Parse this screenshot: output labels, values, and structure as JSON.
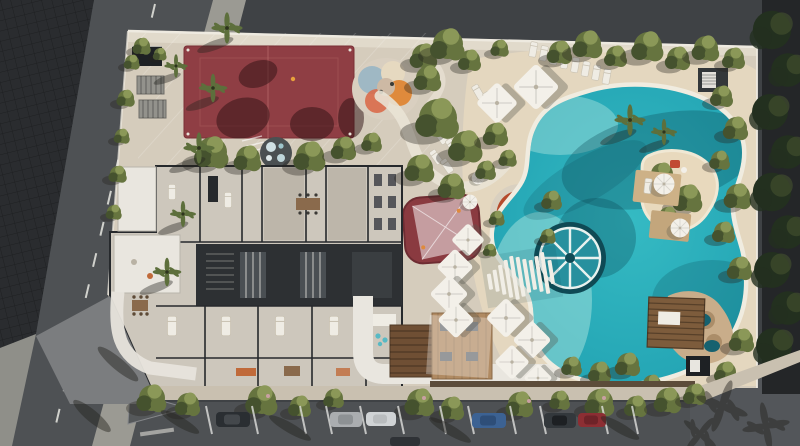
{
  "scene": {
    "description": "Aerial 3D architectural render of a residential amenity site plan: red sports court, children playground, cut-away apartment floor plan, central shaded play pad, sunken fire-pit lounge, large lagoon swimming pool with island, round pool daybed wheel, timber step bridge, beach umbrellas and sun loungers, timber dining deck with pergola, rock grotto spa, perimeter landscaping, surrounding streets with parallel parking.",
    "features": [
      "tennis-court",
      "playground",
      "apartment-floorplan",
      "lagoon-pool",
      "pool-island",
      "pool-daybed-wheel",
      "step-bridge",
      "beach-umbrellas",
      "sun-loungers",
      "fire-pit-lounge",
      "shaded-play-pad",
      "timber-deck",
      "pergola",
      "rock-grotto",
      "street-parking",
      "palm-trees"
    ],
    "counts": {
      "parked_cars": 7,
      "west_pool_umbrellas": 6,
      "street_tree_clusters": 14
    }
  },
  "colors": {
    "asphalt": "#3f4245",
    "asphalt_light": "#4e5154",
    "lot_dark": "#2a2c2f",
    "lane_line": "#e8e7e2",
    "sidewalk": "#9b9a93",
    "plaza": "#7b7d7f",
    "pavement_light": "#8f8f89",
    "curb": "#2f3133",
    "site_sand": "#d5ccbc",
    "beach_sand": "#e4d7bf",
    "path_light": "#e9e3d5",
    "boundary_wall": "#eeeae0",
    "court_red": "#8f3e44",
    "court_line": "#b86a68",
    "court_shadow": "#2e1113",
    "green_dark": "#45522e",
    "green_mid": "#66743f",
    "green_light": "#8b9858",
    "palm_green": "#5d6f3c",
    "tree_dark_edge": "#23301f",
    "blossom": "#c9a0a2",
    "pool_rim": "#f0ece0",
    "pool_mid": "#35bac3",
    "pool_deep": "#1f9fb0",
    "pool_shallow": "#a9e3de",
    "pool_shadow": "#0a4552",
    "island_sand": "#e8d9bd",
    "wheel_fill": "#27909e",
    "wheel_dark": "#0f4a55",
    "wheel_spoke": "#e9f2ef",
    "bridge_slat": "#f1eee6",
    "rock": "#c9ad8a",
    "rock_dark": "#ab8d69",
    "grotto_water": "#16616f",
    "umbrella": "#f3f0e9",
    "umbrella_shade": "#57554c",
    "wood_deck": "#b08a62",
    "pergola_wood": "#6f4f34",
    "cabana_wood": "#7d5c3c",
    "boardwalk": "#5c4c3a",
    "roof_white": "#e9e6df",
    "floor_light": "#cdc7bc",
    "floor_mid": "#bdb6aa",
    "wall_dark": "#26292c",
    "corridor": "#2d3033",
    "corridor_light": "#4a4f53",
    "furniture_wood": "#8a6a4c",
    "bed_white": "#efece4",
    "accent_orange": "#c06a3a",
    "accent_aqua": "#58b9c4",
    "red_pad": "#8a3a40",
    "sail_white": "#ffffff",
    "lounge_orange": "#b54a2c",
    "lounge_deck": "#d9d0c0",
    "canopy_orange": "#df8a3c",
    "canopy_blue": "#9fb8c4",
    "canopy_cream": "#e6d9c0",
    "canopy_coral": "#d96a4a",
    "playground_pad": "#d9cfc0",
    "structure_dark": "#1e2124",
    "pergola_gray": "#93928c",
    "car_dark": "#2a2e32",
    "car_silver": "#aaadb0",
    "car_white": "#d0d3d5",
    "car_blue": "#3c6293",
    "car_red": "#8c2e33",
    "car_roof_dark": "#1d2023",
    "shadow_soft": "#24231e"
  }
}
